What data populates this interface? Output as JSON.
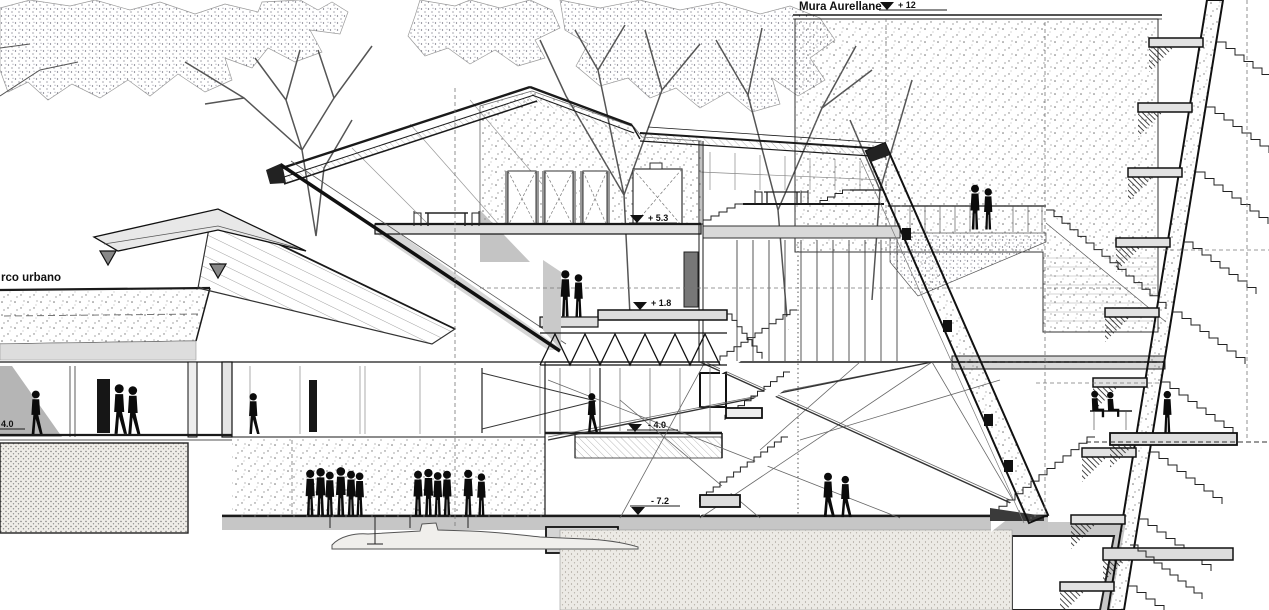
{
  "drawing": {
    "labels": {
      "wall_name": "Mura Aurellane",
      "park_name": "rco urbano"
    },
    "elevations": {
      "wall_top": "+ 12",
      "mezzanine": "+ 5.3",
      "terrace": "+ 1.8",
      "lower_level": "- 4.0",
      "excavation": "- 7.2",
      "left_edge": "4.0"
    },
    "colors": {
      "linework": "#1a1a1a",
      "paper": "#ffffff",
      "shading": "#c8c8c8"
    }
  }
}
